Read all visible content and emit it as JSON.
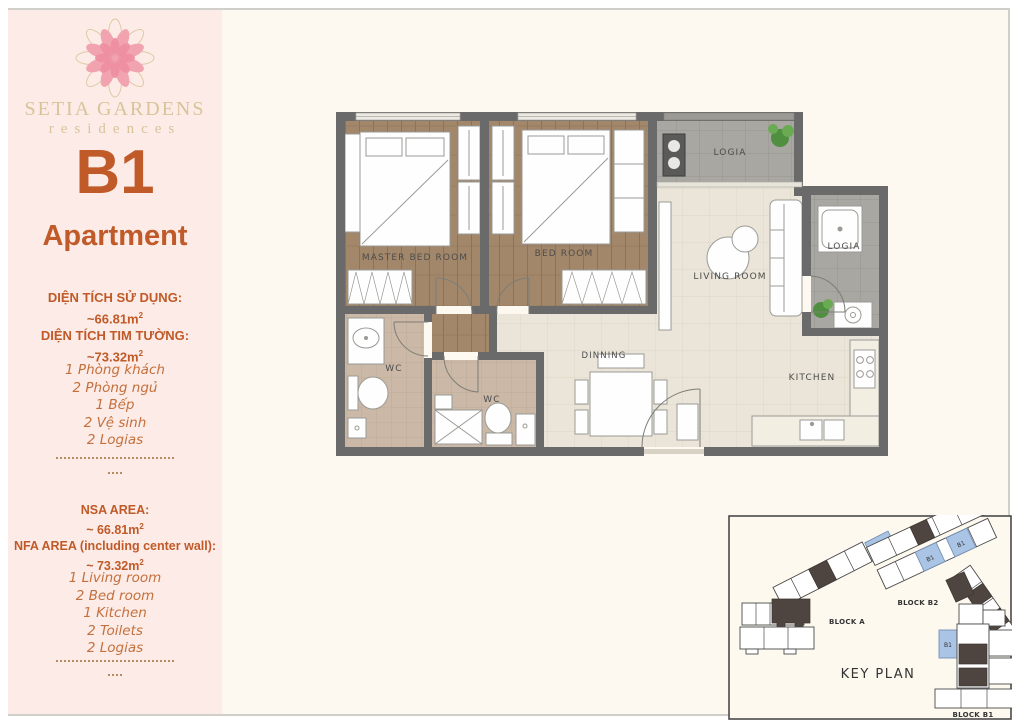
{
  "sidebar": {
    "brand_name": "SETIA GARDENS",
    "brand_sub": "residences",
    "unit_code": "B1",
    "unit_type": "Apartment",
    "sup": "2",
    "vi": {
      "area1_label": "DIỆN TÍCH SỬ DỤNG:",
      "area1_value": "~66.81m",
      "area2_label": "DIỆN TÍCH TIM TƯỜNG:",
      "area2_value": "~73.32m",
      "items": [
        "1 Phòng khách",
        "2 Phòng ngủ",
        "1 Bếp",
        "2 Vệ sinh",
        "2 Logias"
      ]
    },
    "en": {
      "area1_label": "NSA AREA:",
      "area1_value": "~ 66.81m",
      "area2_label": "NFA AREA (including center wall):",
      "area2_value": "~ 73.32m",
      "items": [
        "1 Living room",
        "2 Bed room",
        "1 Kitchen",
        "2 Toilets",
        "2 Logias"
      ]
    }
  },
  "floorplan": {
    "labels": {
      "master_bedroom": "MASTER BED ROOM",
      "bedroom": "BED ROOM",
      "logia_top": "LOGIA",
      "logia_right": "LOGIA",
      "living_room": "LIVING ROOM",
      "wc_master": "WC",
      "wc_common": "WC",
      "dinning": "DINNING",
      "kitchen": "KITCHEN"
    }
  },
  "keyplan": {
    "title": "KEY PLAN",
    "unit_label": "B1",
    "block_a": "BLOCK A",
    "block_b2": "BLOCK B2",
    "block_b1": "BLOCK B1"
  },
  "colors": {
    "accent": "#c05a28",
    "sidebar_bg": "#fcebe6",
    "page_bg": "#fdf9f1",
    "wall": "#6a6a6a",
    "highlight_unit": "#a9c4e4"
  }
}
